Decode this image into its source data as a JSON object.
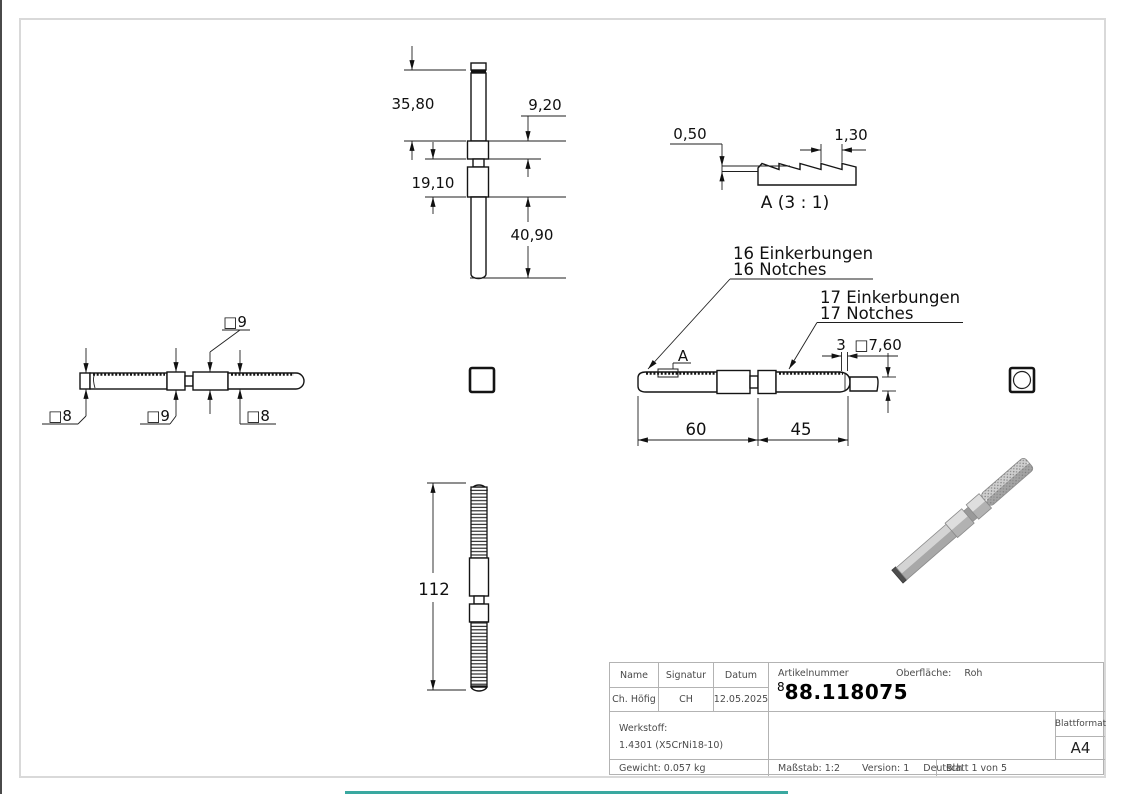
{
  "drawing": {
    "front_view": {
      "dim1": "35,80",
      "dim2": "9,20",
      "dim3": "19,10",
      "dim4": "40,90"
    },
    "detail_view": {
      "dim_depth": "0,50",
      "dim_pitch": "1,30",
      "title": "A (3 : 1)"
    },
    "side_view": {
      "sq9_top": "□9",
      "sq8_left": "□8",
      "sq9_mid": "□9",
      "sq8_right": "□8"
    },
    "plan_view": {
      "notches16_de": "16 Einkerbungen",
      "notches16_en": "16 Notches",
      "notches17_de": "17 Einkerbungen",
      "notches17_en": "17 Notches",
      "detail_marker": "A",
      "dim_gap": "3",
      "dim_square": "□7,60",
      "dim_left": "60",
      "dim_right": "45"
    },
    "length_view": {
      "dim_total": "112"
    }
  },
  "title_block": {
    "col_name": "Name",
    "col_signatur": "Signatur",
    "col_datum": "Datum",
    "name": "Ch. Höfig",
    "signatur": "CH",
    "datum": "12.05.2025",
    "artikelnummer_label": "Artikelnummer",
    "artikelnummer_prefix": "8",
    "artikelnummer": "88.118075",
    "oberflaeche_label": "Oberfläche:",
    "oberflaeche_value": "Roh",
    "werkstoff_label": "Werkstoff:",
    "werkstoff_value": "1.4301 (X5CrNi18-10)",
    "gewicht": "Gewicht: 0.057 kg",
    "massstab": "Maßstab: 1:2",
    "version": "Version: 1",
    "sprache": "Deutsch",
    "blatt": "Blatt 1 von 5",
    "blattformat_label": "Blattformat",
    "blattformat_value": "A4"
  }
}
